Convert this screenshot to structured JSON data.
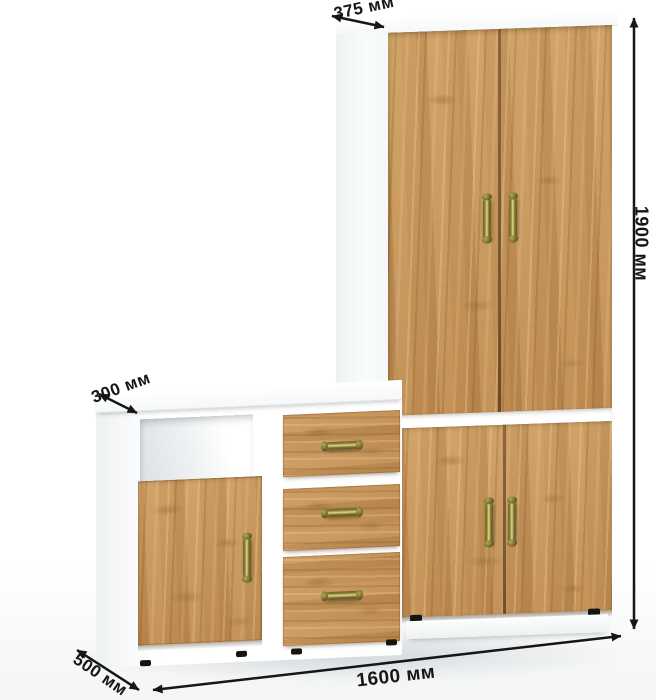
{
  "dimensions": {
    "wardrobe_depth": {
      "label": "375 мм"
    },
    "height": {
      "label": "1900 мм"
    },
    "cabinet_depth": {
      "label": "300 мм"
    },
    "base_depth": {
      "label": "500 мм"
    },
    "width": {
      "label": "1600 мм"
    }
  },
  "colors": {
    "wood": "#c4935a",
    "wood_dark": "#9a7340",
    "wood_light": "#dcb177",
    "carcass_white": "#ffffff",
    "shade_gray": "#e8ecee",
    "handle_brass": "#9d9140",
    "dimension_ink": "#161616",
    "background": "#ffffff"
  }
}
